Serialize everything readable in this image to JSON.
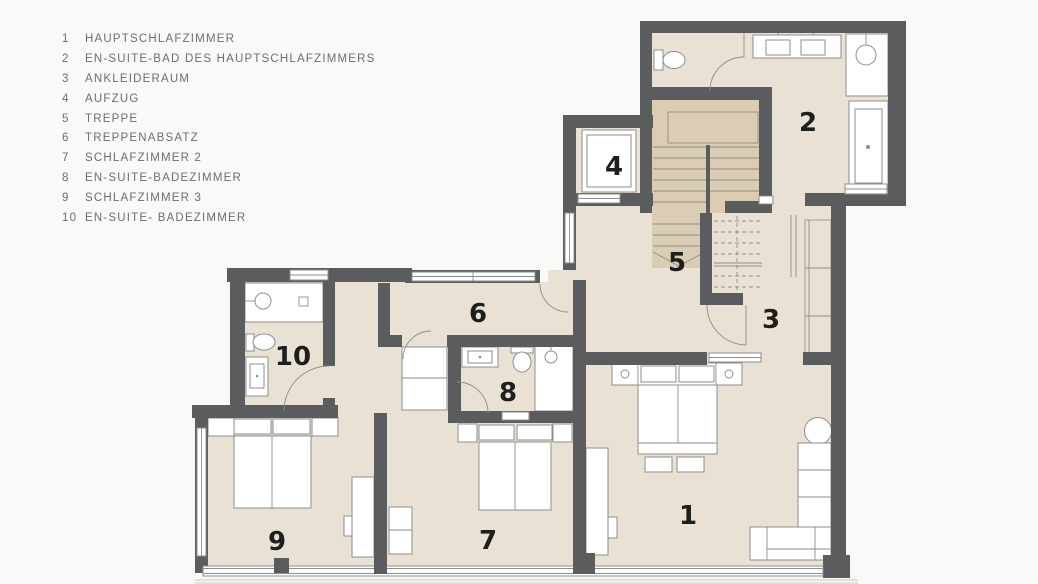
{
  "legend": {
    "items": [
      {
        "number": "1",
        "label": "HAUPTSCHLAFZIMMER"
      },
      {
        "number": "2",
        "label": "EN-SUITE-BAD DES HAUPTSCHLAFZIMMERS"
      },
      {
        "number": "3",
        "label": "ANKLEIDERAUM"
      },
      {
        "number": "4",
        "label": "AUFZUG"
      },
      {
        "number": "5",
        "label": "TREPPE"
      },
      {
        "number": "6",
        "label": "TREPPENABSATZ"
      },
      {
        "number": "7",
        "label": "SCHLAFZIMMER 2"
      },
      {
        "number": "8",
        "label": "EN-SUITE-BADEZIMMER"
      },
      {
        "number": "9",
        "label": "SCHLAFZIMMER 3"
      },
      {
        "number": "10",
        "label": "EN-SUITE- BADEZIMMER"
      }
    ]
  },
  "plan": {
    "room_numbers": [
      "1",
      "2",
      "3",
      "4",
      "5",
      "6",
      "7",
      "8",
      "9",
      "10"
    ]
  },
  "colors": {
    "background": "#f9f9f8",
    "floor": "#e9e1d4",
    "stair": "#dbcdb3",
    "wall": "#5a5c5e",
    "furniture_stroke": "#8e8e8c",
    "legend_text": "#6a6e71",
    "room_number_text": "#1e1e1c"
  }
}
